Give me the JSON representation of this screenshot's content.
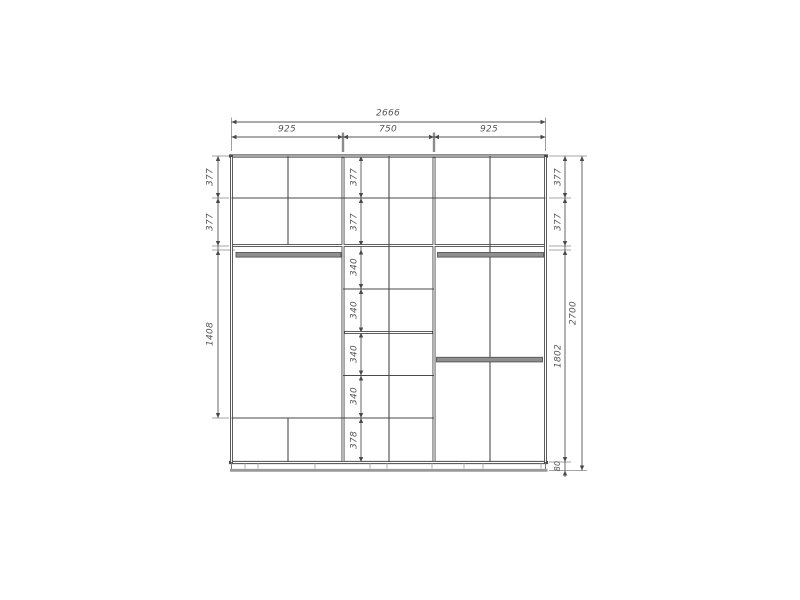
{
  "drawing": {
    "type": "wardrobe-elevation-dimension-drawing",
    "colors": {
      "background": "#ffffff",
      "structure_line": "#4a4a4a",
      "dimension_line": "#555555",
      "extension_line": "#888888",
      "rod_fill": "#8f8f8f",
      "plinth_line": "#9a9a9a",
      "label_text": "#555555"
    },
    "overall_width": "2666",
    "overall_height": "2700",
    "top_sections": [
      "925",
      "750",
      "925"
    ],
    "left_chain": [
      "377",
      "377",
      "1408"
    ],
    "middle_chain": [
      "377",
      "377",
      "340",
      "340",
      "340",
      "340",
      "378"
    ],
    "right_chain": [
      "377",
      "377",
      "1802",
      "80"
    ]
  }
}
